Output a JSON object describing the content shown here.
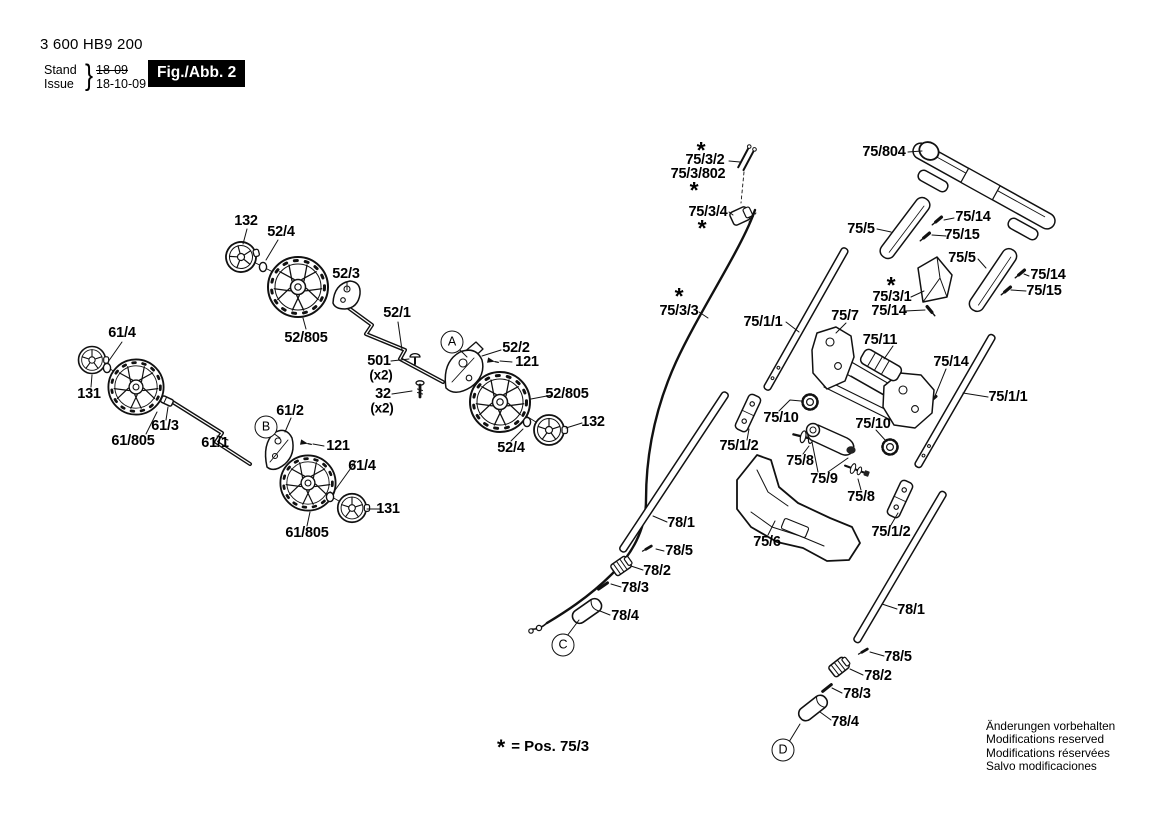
{
  "header": {
    "part_number": "3 600 HB9 200",
    "stand_label": "Stand",
    "issue_label": "Issue",
    "brace": "}",
    "stand_value": "18-09",
    "issue_value": "18-10-09",
    "fig_label": "Fig./Abb. 2"
  },
  "footnote": {
    "star": "*",
    "text": "= Pos. 75/3"
  },
  "footer": {
    "lines": [
      "Änderungen vorbehalten",
      "Modifications reserved",
      "Modifications réservées",
      "Salvo modificaciones"
    ]
  },
  "colors": {
    "ink": "#111111",
    "background": "#ffffff",
    "fig_box_bg": "#000000",
    "fig_box_text": "#ffffff"
  },
  "diagram": {
    "labels": [
      {
        "text": "132",
        "x": 246,
        "y": 221
      },
      {
        "text": "52/4",
        "x": 281,
        "y": 232
      },
      {
        "text": "52/3",
        "x": 346,
        "y": 274
      },
      {
        "text": "52/805",
        "x": 306,
        "y": 338
      },
      {
        "text": "52/1",
        "x": 397,
        "y": 313
      },
      {
        "text": "52/2",
        "x": 516,
        "y": 348
      },
      {
        "text": "121",
        "x": 527,
        "y": 362
      },
      {
        "text": "501",
        "x": 379,
        "y": 361
      },
      {
        "text": "(x2)",
        "x": 381,
        "y": 375,
        "cls": "x2"
      },
      {
        "text": "32",
        "x": 383,
        "y": 394
      },
      {
        "text": "(x2)",
        "x": 382,
        "y": 408,
        "cls": "x2"
      },
      {
        "text": "52/805",
        "x": 567,
        "y": 394
      },
      {
        "text": "132",
        "x": 593,
        "y": 422
      },
      {
        "text": "52/4",
        "x": 511,
        "y": 448
      },
      {
        "text": "61/4",
        "x": 122,
        "y": 333
      },
      {
        "text": "131",
        "x": 89,
        "y": 394
      },
      {
        "text": "61/3",
        "x": 165,
        "y": 426
      },
      {
        "text": "61/805",
        "x": 133,
        "y": 441
      },
      {
        "text": "61/1",
        "x": 215,
        "y": 443
      },
      {
        "text": "61/2",
        "x": 290,
        "y": 411
      },
      {
        "text": "121",
        "x": 338,
        "y": 446
      },
      {
        "text": "61/4",
        "x": 362,
        "y": 466
      },
      {
        "text": "131",
        "x": 388,
        "y": 509
      },
      {
        "text": "61/805",
        "x": 307,
        "y": 533
      },
      {
        "text": "*",
        "x": 701,
        "y": 146,
        "cls": "star"
      },
      {
        "text": "75/3/2",
        "x": 705,
        "y": 160
      },
      {
        "text": "75/3/802",
        "x": 698,
        "y": 174
      },
      {
        "text": "*",
        "x": 694,
        "y": 186,
        "cls": "star"
      },
      {
        "text": "75/3/4",
        "x": 708,
        "y": 212
      },
      {
        "text": "*",
        "x": 702,
        "y": 224,
        "cls": "star"
      },
      {
        "text": "*",
        "x": 679,
        "y": 292,
        "cls": "star"
      },
      {
        "text": "75/3/3",
        "x": 679,
        "y": 311
      },
      {
        "text": "75/1/1",
        "x": 763,
        "y": 322
      },
      {
        "text": "75/804",
        "x": 884,
        "y": 152
      },
      {
        "text": "75/5",
        "x": 861,
        "y": 229
      },
      {
        "text": "75/14",
        "x": 973,
        "y": 217
      },
      {
        "text": "75/15",
        "x": 962,
        "y": 235
      },
      {
        "text": "75/5",
        "x": 962,
        "y": 258
      },
      {
        "text": "75/14",
        "x": 1048,
        "y": 275
      },
      {
        "text": "75/15",
        "x": 1044,
        "y": 291
      },
      {
        "text": "*",
        "x": 891,
        "y": 281,
        "cls": "star"
      },
      {
        "text": "75/3/1",
        "x": 892,
        "y": 297
      },
      {
        "text": "75/14",
        "x": 889,
        "y": 311
      },
      {
        "text": "75/7",
        "x": 845,
        "y": 316
      },
      {
        "text": "75/11",
        "x": 880,
        "y": 340
      },
      {
        "text": "75/14",
        "x": 951,
        "y": 362
      },
      {
        "text": "75/1/1",
        "x": 1008,
        "y": 397
      },
      {
        "text": "75/10",
        "x": 781,
        "y": 418
      },
      {
        "text": "75/10",
        "x": 873,
        "y": 424
      },
      {
        "text": "75/1/2",
        "x": 739,
        "y": 446
      },
      {
        "text": "75/8",
        "x": 800,
        "y": 461
      },
      {
        "text": "75/9",
        "x": 824,
        "y": 479
      },
      {
        "text": "75/8",
        "x": 861,
        "y": 497
      },
      {
        "text": "75/6",
        "x": 767,
        "y": 542
      },
      {
        "text": "75/1/2",
        "x": 891,
        "y": 532
      },
      {
        "text": "78/1",
        "x": 681,
        "y": 523
      },
      {
        "text": "78/5",
        "x": 679,
        "y": 551
      },
      {
        "text": "78/2",
        "x": 657,
        "y": 571
      },
      {
        "text": "78/3",
        "x": 635,
        "y": 588
      },
      {
        "text": "78/4",
        "x": 625,
        "y": 616
      },
      {
        "text": "78/1",
        "x": 911,
        "y": 610
      },
      {
        "text": "78/5",
        "x": 898,
        "y": 657
      },
      {
        "text": "78/2",
        "x": 878,
        "y": 676
      },
      {
        "text": "78/3",
        "x": 857,
        "y": 694
      },
      {
        "text": "78/4",
        "x": 845,
        "y": 722
      }
    ],
    "callouts": [
      {
        "letter": "A",
        "x": 452,
        "y": 342
      },
      {
        "letter": "B",
        "x": 266,
        "y": 427
      },
      {
        "letter": "C",
        "x": 563,
        "y": 645
      },
      {
        "letter": "D",
        "x": 783,
        "y": 750
      }
    ]
  }
}
